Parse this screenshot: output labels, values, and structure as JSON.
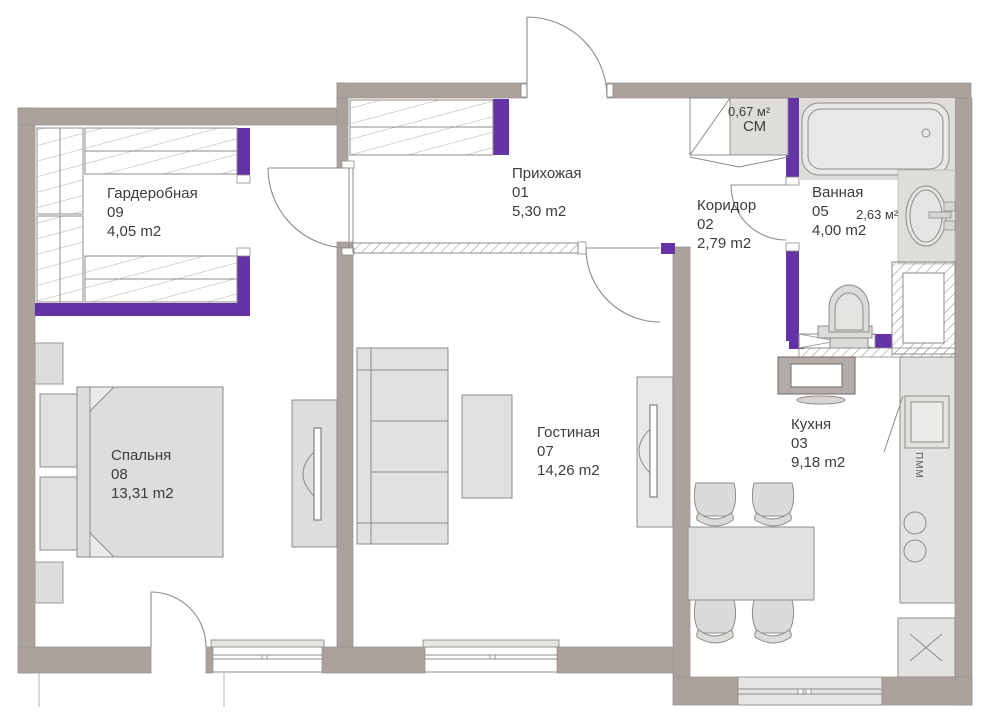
{
  "plan": {
    "rooms": [
      {
        "id": "hallway",
        "name": "Прихожая",
        "number": "01",
        "area": "5,30 m2"
      },
      {
        "id": "corridor",
        "name": "Коридор",
        "number": "02",
        "area": "2,79 m2"
      },
      {
        "id": "kitchen",
        "name": "Кухня",
        "number": "03",
        "area": "9,18 m2"
      },
      {
        "id": "bathroom",
        "name": "Ванная",
        "number": "05",
        "area": "4,00 m2"
      },
      {
        "id": "living",
        "name": "Гостиная",
        "number": "07",
        "area": "14,26 m2"
      },
      {
        "id": "bedroom",
        "name": "Спальня",
        "number": "08",
        "area": "13,31 m2"
      },
      {
        "id": "wardrobe",
        "name": "Гардеробная",
        "number": "09",
        "area": "4,05 m2"
      }
    ],
    "annotations": {
      "closet_area": "0,67 м²",
      "closet_label": "СМ",
      "bath_zone_area": "2,63 м²",
      "appliance_label": "ПММ"
    },
    "colors": {
      "wall_gray": "#aba29d",
      "accent_purple": "#6433a6",
      "furniture_fill": "#e1e0de",
      "line_gray": "#8e8c89"
    }
  }
}
